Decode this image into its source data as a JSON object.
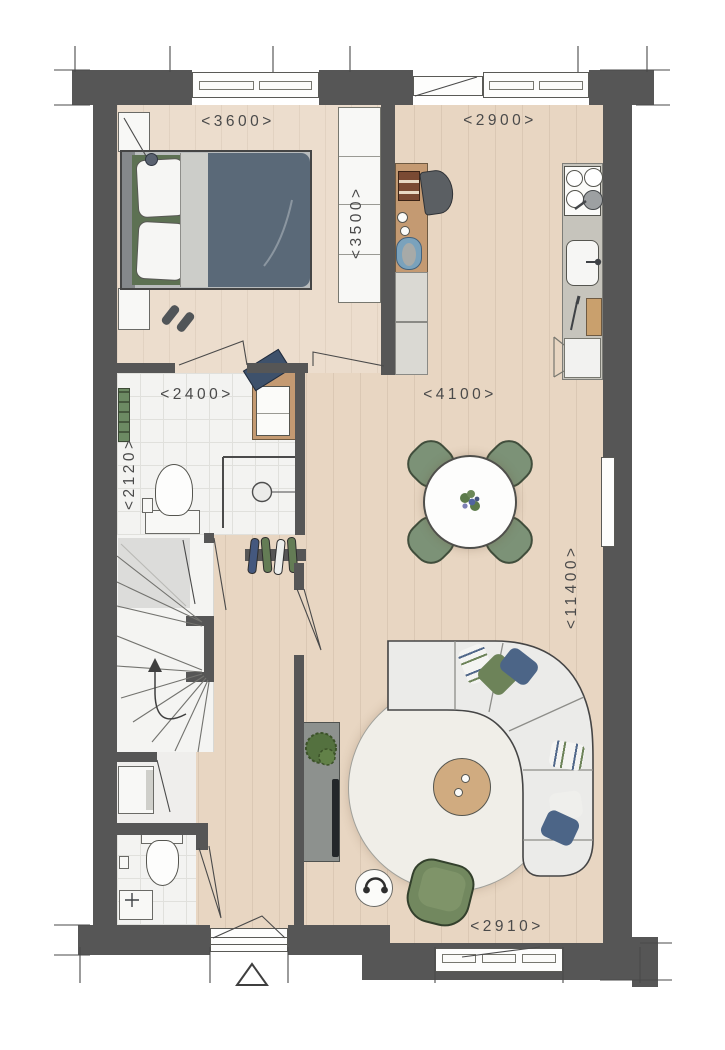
{
  "plan": {
    "type": "floor-plan",
    "dimension_labels": {
      "bedroom_width": "<3600>",
      "kitchen_width": "<2900>",
      "closet_depth": "<3500>",
      "bathroom_width": "<2400>",
      "bathroom_depth": "<2120>",
      "living_width": "<4100>",
      "dwelling_depth": "<11400>",
      "living_window_width": "<2910>"
    },
    "colors": {
      "wall": "#565656",
      "floor": "#e8d6c2",
      "floor_bedroom": "#ecddcd",
      "tile": "#f3f3f1",
      "stair": "#f4f4f2",
      "white_furniture": "#f8f8f6",
      "counter": "#c6c4bc",
      "wood_furniture": "#c49a72",
      "green": "#7c9277",
      "green_dark": "#5d7153",
      "blue": "#4c6587",
      "duvet": "#5a6978",
      "rug": "#f0eee8",
      "sofa": "#ebebe9",
      "cabinet_gray": "#8d918e",
      "ink": "#4a4a4a"
    }
  }
}
